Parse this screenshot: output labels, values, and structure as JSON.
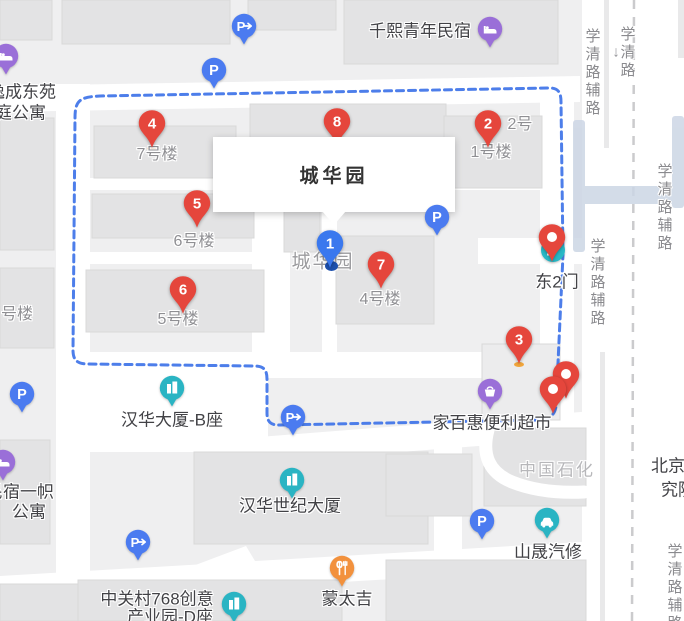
{
  "infobox": {
    "title": "城华园"
  },
  "colors": {
    "marker_red": "#e5463c",
    "marker_blue": "#3a78ee",
    "boundary_blue": "#3e73e8",
    "poi_teal": "#2ab4c3",
    "poi_purple": "#9a6fd8",
    "poi_blue": "#4b7bf0",
    "poi_orange": "#f2913d",
    "metro_teal": "#28b8c6",
    "map_bg": "#efeff0",
    "road_white": "#ffffff"
  },
  "markers": [
    {
      "name": "marker-8",
      "label": "8",
      "x": 337,
      "y": 146,
      "type": "red",
      "z": 5
    },
    {
      "name": "marker-4",
      "label": "4",
      "x": 152,
      "y": 148,
      "type": "red",
      "z": 20,
      "base_dot": true
    },
    {
      "name": "marker-2",
      "label": "2",
      "x": 488,
      "y": 148,
      "type": "red",
      "z": 20
    },
    {
      "name": "marker-5",
      "label": "5",
      "x": 197,
      "y": 228,
      "type": "red",
      "z": 20
    },
    {
      "name": "marker-1",
      "label": "1",
      "x": 330,
      "y": 268,
      "type": "blue",
      "z": 20,
      "shadow_dot": true
    },
    {
      "name": "marker-7",
      "label": "7",
      "x": 381,
      "y": 289,
      "type": "red",
      "z": 20
    },
    {
      "name": "marker-6",
      "label": "6",
      "x": 183,
      "y": 314,
      "type": "red",
      "z": 20
    },
    {
      "name": "marker-3",
      "label": "3",
      "x": 519,
      "y": 364,
      "type": "red",
      "z": 21,
      "base_dot": true
    },
    {
      "name": "gate-pin",
      "label": "",
      "x": 552,
      "y": 262,
      "type": "dot",
      "z": 20
    },
    {
      "name": "cluster-pin-back",
      "label": "",
      "x": 566,
      "y": 399,
      "type": "dot",
      "z": 21
    },
    {
      "name": "cluster-pin-front",
      "label": "",
      "x": 553,
      "y": 414,
      "type": "dot",
      "z": 22
    }
  ],
  "poi_icons": [
    {
      "name": "hotel-icon",
      "type": "hotel",
      "x": 490,
      "y": 29,
      "color": "#9a6fd8"
    },
    {
      "name": "hotel-icon",
      "type": "hotel",
      "x": 6,
      "y": 56,
      "color": "#9a6fd8"
    },
    {
      "name": "hotel-icon",
      "type": "hotel",
      "x": 3,
      "y": 462,
      "color": "#9a6fd8"
    },
    {
      "name": "parking-exit-icon",
      "type": "parking-arrow",
      "x": 244,
      "y": 26,
      "color": "#4b7bf0"
    },
    {
      "name": "parking-icon",
      "type": "parking",
      "x": 214,
      "y": 70,
      "color": "#4b7bf0"
    },
    {
      "name": "parking-icon",
      "type": "parking",
      "x": 437,
      "y": 217,
      "color": "#4b7bf0"
    },
    {
      "name": "parking-icon",
      "type": "parking",
      "x": 22,
      "y": 394,
      "color": "#4b7bf0"
    },
    {
      "name": "parking-exit-icon",
      "type": "parking-arrow",
      "x": 293,
      "y": 417,
      "color": "#4b7bf0"
    },
    {
      "name": "parking-exit-icon",
      "type": "parking-arrow",
      "x": 138,
      "y": 542,
      "color": "#4b7bf0"
    },
    {
      "name": "parking-icon",
      "type": "parking",
      "x": 482,
      "y": 521,
      "color": "#4b7bf0"
    },
    {
      "name": "office-building-icon",
      "type": "building",
      "x": 172,
      "y": 388,
      "color": "#2ab4c3"
    },
    {
      "name": "office-building-icon",
      "type": "building",
      "x": 292,
      "y": 480,
      "color": "#2ab4c3"
    },
    {
      "name": "office-building-icon",
      "type": "building",
      "x": 234,
      "y": 604,
      "color": "#2ab4c3"
    },
    {
      "name": "supermarket-icon",
      "type": "basket",
      "x": 490,
      "y": 391,
      "color": "#9a6fd8"
    },
    {
      "name": "car-repair-icon",
      "type": "car",
      "x": 547,
      "y": 520,
      "color": "#2ab4c3"
    },
    {
      "name": "restaurant-icon",
      "type": "restaurant",
      "x": 342,
      "y": 568,
      "color": "#f2913d"
    },
    {
      "name": "subway-entrance-icon",
      "type": "metro",
      "x": 553,
      "y": 250,
      "color": "#28b8c6"
    }
  ],
  "labels": [
    {
      "name": "poi-label-qianxi",
      "text": "千熙青年民宿",
      "x": 420,
      "y": 29,
      "cls": "dark"
    },
    {
      "name": "building-label",
      "text": "7号楼",
      "x": 157,
      "y": 152,
      "cls": ""
    },
    {
      "name": "building-label",
      "text": "6号楼",
      "x": 194,
      "y": 239,
      "cls": ""
    },
    {
      "name": "building-label",
      "text": "5号楼",
      "x": 178,
      "y": 317,
      "cls": ""
    },
    {
      "name": "building-label",
      "text": "4号楼",
      "x": 380,
      "y": 297,
      "cls": ""
    },
    {
      "name": "building-label",
      "text": "1号楼",
      "x": 491,
      "y": 150,
      "cls": ""
    },
    {
      "name": "building-label",
      "text": "2号",
      "x": 520,
      "y": 122,
      "cls": ""
    },
    {
      "name": "building-label",
      "text": "号楼",
      "x": 17,
      "y": 312,
      "cls": ""
    },
    {
      "name": "compound-map-label",
      "text": "城华园",
      "x": 323,
      "y": 260,
      "cls": "big-gray"
    },
    {
      "name": "poi-label-gate",
      "text": "东2门",
      "x": 557,
      "y": 280,
      "cls": "dark"
    },
    {
      "name": "poi-label-hanhua-b",
      "text": "汉华大厦-B座",
      "x": 172,
      "y": 418,
      "cls": "dark"
    },
    {
      "name": "poi-label-supermarket",
      "text": "家百惠便利超市",
      "x": 492,
      "y": 421,
      "cls": "dark"
    },
    {
      "name": "poi-label-sinopec",
      "text": "中国石化",
      "x": 557,
      "y": 468,
      "cls": "sinopec"
    },
    {
      "name": "poi-label-hanhua-cent",
      "text": "汉华世纪大厦",
      "x": 290,
      "y": 504,
      "cls": "dark"
    },
    {
      "name": "poi-label-autorepair",
      "text": "山晟汽修",
      "x": 548,
      "y": 550,
      "cls": "dark"
    },
    {
      "name": "poi-label-mengtaiji",
      "text": "蒙太吉",
      "x": 347,
      "y": 597,
      "cls": "dark"
    },
    {
      "name": "poi-label-zgc768-1",
      "text": "中关村768创意",
      "x": 157,
      "y": 597,
      "cls": "dark"
    },
    {
      "name": "poi-label-zgc768-2",
      "text": "产业园-D座",
      "x": 170,
      "y": 615,
      "cls": "dark"
    },
    {
      "name": "poi-label-yicheng-1",
      "text": "逸成东苑",
      "x": -12,
      "y": 90,
      "cls": "dark",
      "anchor": "left"
    },
    {
      "name": "poi-label-yicheng-2",
      "text": "家庭公寓",
      "x": -22,
      "y": 111,
      "cls": "dark",
      "anchor": "left"
    },
    {
      "name": "poi-label-minsu-1",
      "text": "民宿一帜",
      "x": -14,
      "y": 490,
      "cls": "dark",
      "anchor": "left"
    },
    {
      "name": "poi-label-minsu-2",
      "text": "公寓",
      "x": 12,
      "y": 510,
      "cls": "dark",
      "anchor": "left"
    },
    {
      "name": "poi-label-beijing-1",
      "text": "北京",
      "x": 668,
      "y": 464,
      "cls": "dark"
    },
    {
      "name": "poi-label-beijing-2",
      "text": "究院",
      "x": 678,
      "y": 488,
      "cls": "dark"
    },
    {
      "name": "direction-arrow",
      "text": "↓",
      "x": 616,
      "y": 52,
      "cls": "arrow"
    }
  ],
  "road_labels": [
    {
      "name": "road-label-xueqinglu-fulu",
      "text": "学清路辅路",
      "x": 592,
      "y": 28
    },
    {
      "name": "road-label-xueqinglu",
      "text": "学清路",
      "x": 627,
      "y": 26
    },
    {
      "name": "road-label-xueqinglu-fulu",
      "text": "学清路辅路",
      "x": 664,
      "y": 163
    },
    {
      "name": "road-label-xueqinglu-fulu",
      "text": "学清路辅路",
      "x": 597,
      "y": 238
    },
    {
      "name": "road-label-xueqinglu-fulu",
      "text": "学清路辅路",
      "x": 674,
      "y": 543
    }
  ]
}
